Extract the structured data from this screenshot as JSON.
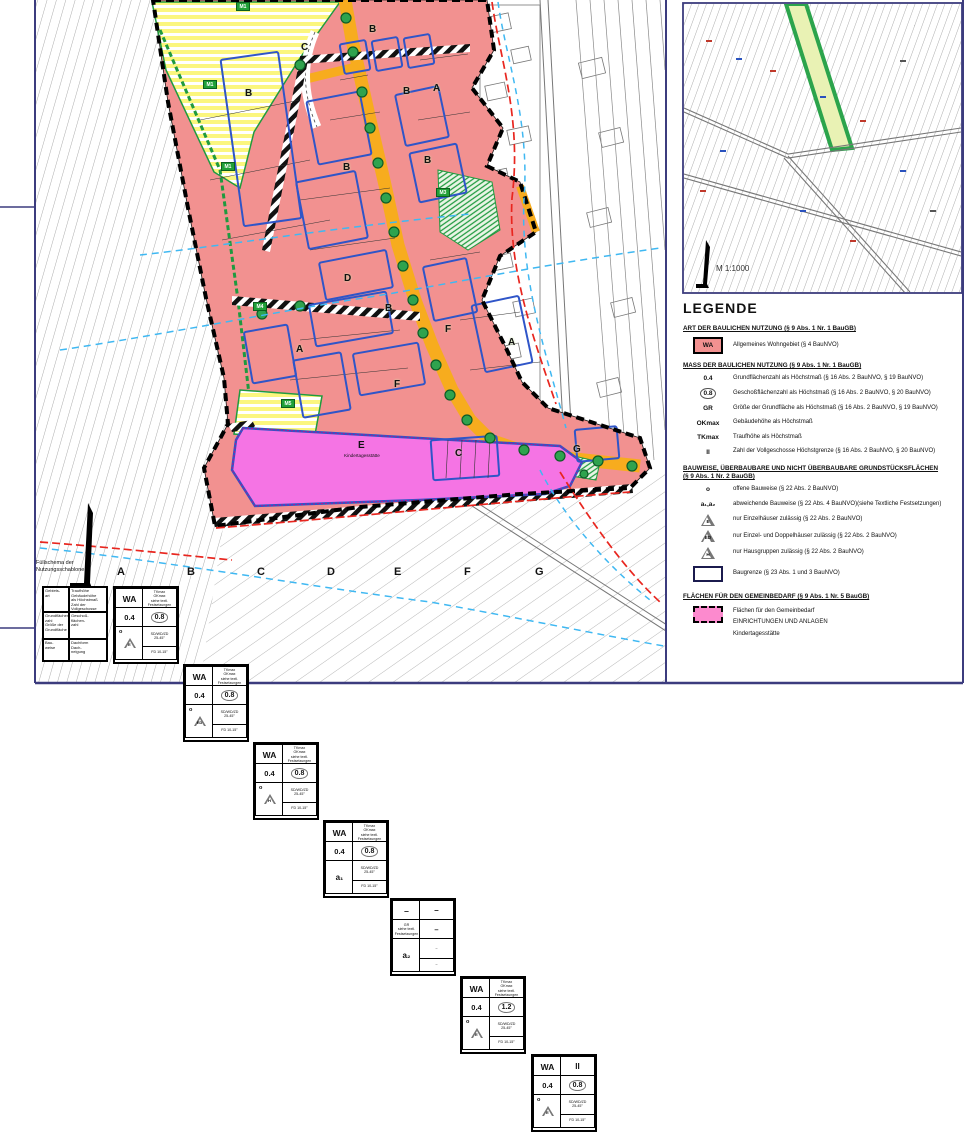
{
  "page": {
    "inset_scale": "M 1:1000"
  },
  "map": {
    "zones": [
      {
        "letter": "B",
        "x": 245,
        "y": 88
      },
      {
        "letter": "C",
        "x": 301,
        "y": 42
      },
      {
        "letter": "B",
        "x": 369,
        "y": 24
      },
      {
        "letter": "B",
        "x": 403,
        "y": 86
      },
      {
        "letter": "A",
        "x": 433,
        "y": 83
      },
      {
        "letter": "B",
        "x": 424,
        "y": 155
      },
      {
        "letter": "B",
        "x": 343,
        "y": 162
      },
      {
        "letter": "D",
        "x": 344,
        "y": 273
      },
      {
        "letter": "B",
        "x": 385,
        "y": 303
      },
      {
        "letter": "F",
        "x": 445,
        "y": 324
      },
      {
        "letter": "A",
        "x": 296,
        "y": 344
      },
      {
        "letter": "A",
        "x": 508,
        "y": 337
      },
      {
        "letter": "F",
        "x": 394,
        "y": 379
      },
      {
        "letter": "C",
        "x": 455,
        "y": 448
      },
      {
        "letter": "G",
        "x": 573,
        "y": 444
      }
    ],
    "markers": [
      {
        "label": "M1",
        "x": 236,
        "y": 2
      },
      {
        "label": "M1",
        "x": 203,
        "y": 80
      },
      {
        "label": "M1",
        "x": 221,
        "y": 162
      },
      {
        "label": "M3",
        "x": 436,
        "y": 188
      },
      {
        "label": "M4",
        "x": 253,
        "y": 302
      },
      {
        "label": "M5",
        "x": 281,
        "y": 399
      }
    ],
    "kita": {
      "letter": "E",
      "name": "Kindertagesstätte",
      "x": 358,
      "y": 440
    }
  },
  "legend": {
    "title": "LEGENDE",
    "s1": {
      "header": "ART DER BAULICHEN NUTZUNG (§ 9 Abs. 1 Nr. 1 BauGB)",
      "sym": "WA",
      "desc": "Allgemeines Wohngebiet (§ 4 BauNVO)"
    },
    "s2": {
      "header": "MASS DER BAULICHEN NUTZUNG (§ 9 Abs. 1 Nr. 1 BauGB)",
      "items": [
        {
          "sym": "0.4",
          "desc": "Grundflächenzahl als Höchstmaß (§ 16 Abs. 2 BauNVO, § 19 BauNVO)"
        },
        {
          "sym": "0.8",
          "desc": "Geschoßflächenzahl als Höchstmaß (§ 16 Abs. 2 BauNVO, § 20 BauNVO)"
        },
        {
          "sym": "GR",
          "desc": "Größe der Grundfläche als Höchstmaß (§ 16 Abs. 2 BauNVO, § 19 BauNVO)"
        },
        {
          "sym": "OKmax",
          "desc": "Gebäudehöhe als Höchstmaß"
        },
        {
          "sym": "TKmax",
          "desc": "Traufhöhe als Höchstmaß"
        },
        {
          "sym": "II",
          "desc": "Zahl der Vollgeschosse Höchstgrenze (§ 16 Abs. 2 BauNVO, § 20 BauNVO)"
        }
      ]
    },
    "s3": {
      "header1": "BAUWEISE, ÜBERBAUBARE UND NICHT ÜBERBAUBARE GRUNDSTÜCKSFLÄCHEN",
      "header2": "(§ 9 Abs. 1 Nr. 2 BauGB)",
      "items": [
        {
          "sym": "o",
          "desc": "offene Bauweise (§ 22 Abs. 2 BauNVO)"
        },
        {
          "sym": "a₁,a₂",
          "desc": "abweichende Bauweise (§ 22 Abs. 4 BauNVO)(siehe Textliche Festsetzungen)"
        },
        {
          "sym": "E",
          "desc": "nur Einzelhäuser zulässig (§ 22 Abs. 2 BauNVO)"
        },
        {
          "sym": "ED",
          "desc": "nur Einzel- und Doppelhäuser zulässig (§ 22 Abs. 2 BauNVO)"
        },
        {
          "sym": "H",
          "desc": "nur Hausgruppen zulässig (§ 22 Abs. 2 BauNVO)"
        },
        {
          "sym": "",
          "desc": "Baugrenze (§ 23 Abs. 1 und 3 BauNVO)"
        }
      ]
    },
    "s4": {
      "header": "FLÄCHEN FÜR DEN GEMEINBEDARF (§ 9 Abs. 1 Nr. 5 BauGB)",
      "lines": [
        "Flächen für den Gemeinbedarf",
        "EINRICHTUNGEN UND ANLAGEN",
        "Kindertagesstätte"
      ]
    }
  },
  "schablone": {
    "title1": "Füllschema der",
    "title2": "Nutzungsschablone",
    "key": {
      "c1": "Gebiets-\nart",
      "c2": "Traufhöhe\nGebäudehöhe\nals Höchstmaß\nZahl der\nVollgeschosse",
      "c3": "Grundflächen-\nzahl\nGröße der\nGrundfläche",
      "c4": "Geschoß-\nflächen-\nzahl",
      "c5": "Bau-\nweise",
      "c6": "Dachform\nDach-\nneigung"
    },
    "columns": [
      {
        "letter": "A",
        "area": "WA",
        "rt": "TKmax\nOKmax\nsiehe textl.\nFestsetzungen",
        "rt_big": false,
        "grz": "0.4",
        "gfz": "0.8",
        "gfz_circ": true,
        "bau_o": true,
        "tri": "E",
        "sub": "",
        "roof1": "SD/WD/ZD\n25-45°",
        "roof2": "FD 10-15°"
      },
      {
        "letter": "B",
        "area": "WA",
        "rt": "TKmax\nOKmax\nsiehe textl.\nFestsetzungen",
        "rt_big": false,
        "grz": "0.4",
        "gfz": "0.8",
        "gfz_circ": true,
        "bau_o": true,
        "tri": "ED",
        "sub": "",
        "roof1": "SD/WD/ZD\n25-45°",
        "roof2": "FD 10-15°"
      },
      {
        "letter": "C",
        "area": "WA",
        "rt": "TKmax\nOKmax\nsiehe textl.\nFestsetzungen",
        "rt_big": false,
        "grz": "0.4",
        "gfz": "0.8",
        "gfz_circ": true,
        "bau_o": true,
        "tri": "H",
        "sub": "",
        "roof1": "SD/WD/ZD\n25-45°",
        "roof2": "FD 10-15°"
      },
      {
        "letter": "D",
        "area": "WA",
        "rt": "TKmax\nOKmax\nsiehe textl.\nFestsetzungen",
        "rt_big": false,
        "grz": "0.4",
        "gfz": "0.8",
        "gfz_circ": true,
        "bau_o": false,
        "tri": "",
        "sub": "a₁",
        "roof1": "SD/WD/ZD\n25-45°",
        "roof2": "FD 10-15°"
      },
      {
        "letter": "E",
        "area": "–",
        "rt": "–",
        "rt_big": true,
        "grz": "GR\nsiehe textl.\nFestsetzungen",
        "gfz": "–",
        "gfz_circ": false,
        "bau_o": false,
        "tri": "",
        "sub": "a₂",
        "roof1": "–",
        "roof2": "–"
      },
      {
        "letter": "F",
        "area": "WA",
        "rt": "TKmax\nOKmax\nsiehe textl.\nFestsetzungen",
        "rt_big": false,
        "grz": "0.4",
        "gfz": "1.2",
        "gfz_circ": true,
        "bau_o": true,
        "tri": "E",
        "sub": "",
        "roof1": "SD/WD/ZD\n25-45°",
        "roof2": "FD 10-15°"
      },
      {
        "letter": "G",
        "area": "WA",
        "rt": "II",
        "rt_big": true,
        "grz": "0.4",
        "gfz": "0.8",
        "gfz_circ": true,
        "bau_o": true,
        "tri": "E",
        "sub": "",
        "roof1": "SD/WD/ZD\n25-45°",
        "roof2": "FD 10-15°"
      }
    ]
  }
}
